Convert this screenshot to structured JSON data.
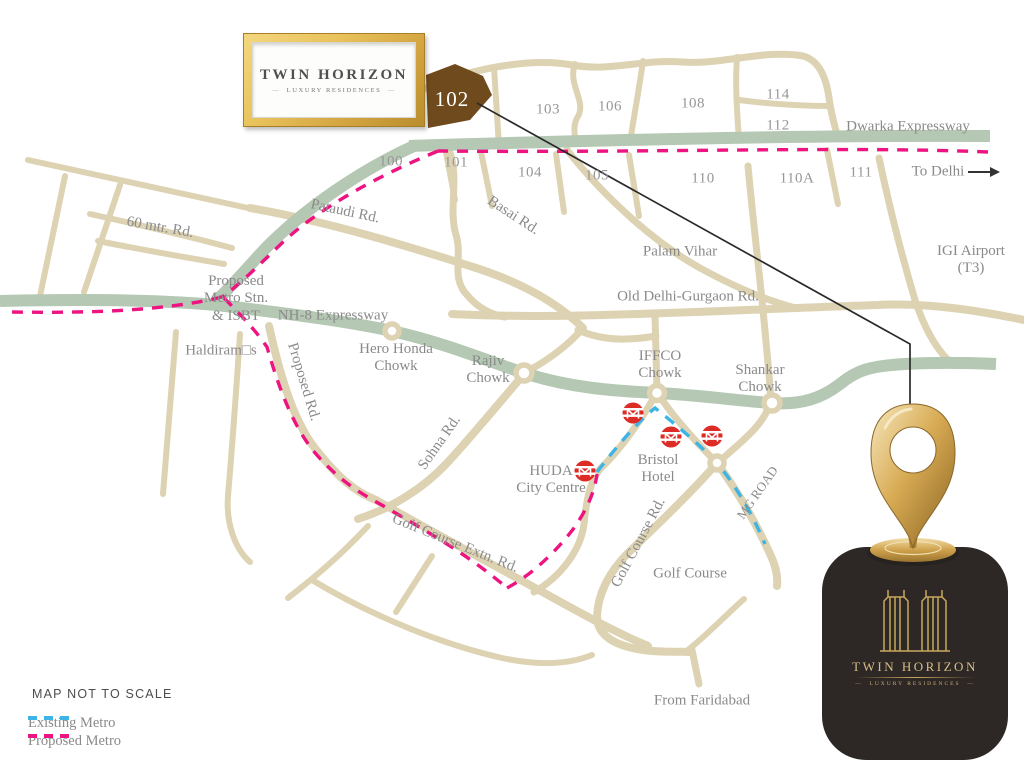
{
  "colors": {
    "road": "#ddd2b2",
    "expressway_green": "#b5c8b3",
    "sector_102_fill": "#6f4a1d",
    "proposed_metro_pink": "#ed1380",
    "existing_metro_blue": "#3cb4e6",
    "label_gray": "#8a8a8a",
    "frame_gold": "#d9ab45",
    "badge_bg": "#2d2825",
    "badge_gold": "#d9bd85",
    "metro_icon_red": "#dd2b26",
    "connector_line": "#2a2a2a"
  },
  "framed_logo": {
    "title": "TWIN HORIZON",
    "subtitle": "LUXURY RESIDENCES"
  },
  "site": {
    "sector": "102"
  },
  "sectors": {
    "s100": "100",
    "s101": "101",
    "s103": "103",
    "s104": "104",
    "s105": "105",
    "s106": "106",
    "s108": "108",
    "s110": "110",
    "s110a": "110A",
    "s111": "111",
    "s112": "112",
    "s114": "114"
  },
  "roads": {
    "dwarka": "Dwarka Expressway",
    "to_delhi": "To Delhi",
    "sixty_mtr": "60 mtr. Rd.",
    "pataudi": "Pataudi Rd.",
    "basai": "Basai Rd.",
    "old_delhi_gurgaon": "Old Delhi-Gurgaon Rd.",
    "nh8": "NH-8 Expressway",
    "proposed_rd": "Proposed Rd.",
    "sohna": "Sohna Rd.",
    "mg_road": "MG ROAD",
    "golf_course_rd": "Golf Course Rd.",
    "golf_course_extn": "Golf Course Extn. Rd."
  },
  "places": {
    "palam_vihar": "Palam Vihar",
    "igi_line1": "IGI Airport",
    "igi_line2": "(T3)",
    "proposed_metro_line1": "Proposed",
    "proposed_metro_line2": "Metro Stn.",
    "proposed_metro_line3": "& ISBT",
    "haldirams": "Haldiram□s",
    "hero_honda_line1": "Hero Honda",
    "hero_honda_line2": "Chowk",
    "rajiv_line1": "Rajiv",
    "rajiv_line2": "Chowk",
    "iffco_line1": "IFFCO",
    "iffco_line2": "Chowk",
    "shankar_line1": "Shankar",
    "shankar_line2": "Chowk",
    "huda_line1": "HUDA",
    "huda_line2": "City Centre",
    "bristol_line1": "Bristol",
    "bristol_line2": "Hotel",
    "golf_course": "Golf Course",
    "from_faridabad": "From Faridabad"
  },
  "legend": {
    "map_not_to_scale": "MAP NOT TO SCALE",
    "existing_metro": "Existing Metro",
    "proposed_metro": "Proposed Metro"
  },
  "badge": {
    "title": "TWIN HORIZON",
    "subtitle": "LUXURY RESIDENCES"
  },
  "icons": {
    "metro_station": "metro-station-icon",
    "location_pin": "location-pin-icon",
    "to_delhi_arrow": "arrow-right-icon",
    "twin_towers": "twin-towers-icon"
  }
}
